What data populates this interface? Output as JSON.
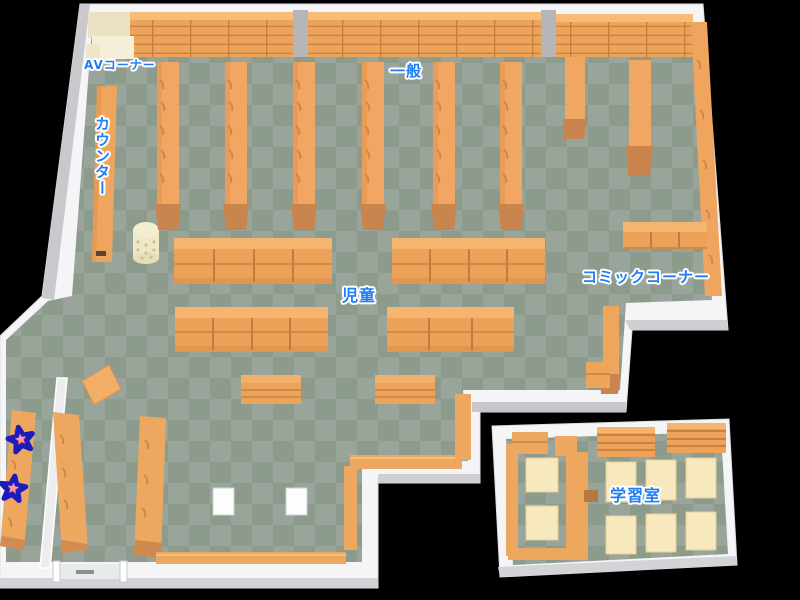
{
  "areas": [
    {
      "id": "av-corner",
      "label": "AVコーナー"
    },
    {
      "id": "general",
      "label": "一般"
    },
    {
      "id": "counter",
      "label": "カウンター"
    },
    {
      "id": "children",
      "label": "児童"
    },
    {
      "id": "comic-corner",
      "label": "コミックコーナー"
    },
    {
      "id": "study-room",
      "label": "学習室"
    }
  ],
  "markers": {
    "shape": "star",
    "count": 2,
    "fill": "#e9414f",
    "inner": "#f79ca5",
    "outline": "#1b1bbe"
  },
  "colors": {
    "background": "#000000",
    "floor_light": "#99a49a",
    "floor_dark": "#8d9b8d",
    "wall": "#f5f5f7",
    "wall_shade": "#c9c9cd",
    "shelf_top": "#f6b46e",
    "shelf": "#eda25a",
    "shelf_line": "#c9813f",
    "shelf_cap": "#c9854d",
    "counter_wood": "#f0a55e",
    "table_cream": "#f7e9bd",
    "unit_cream": "#efe5c9",
    "pillar_gray": "#b6b6ba",
    "label_text": "#1e7ef2",
    "label_outline": "#ffffff"
  }
}
